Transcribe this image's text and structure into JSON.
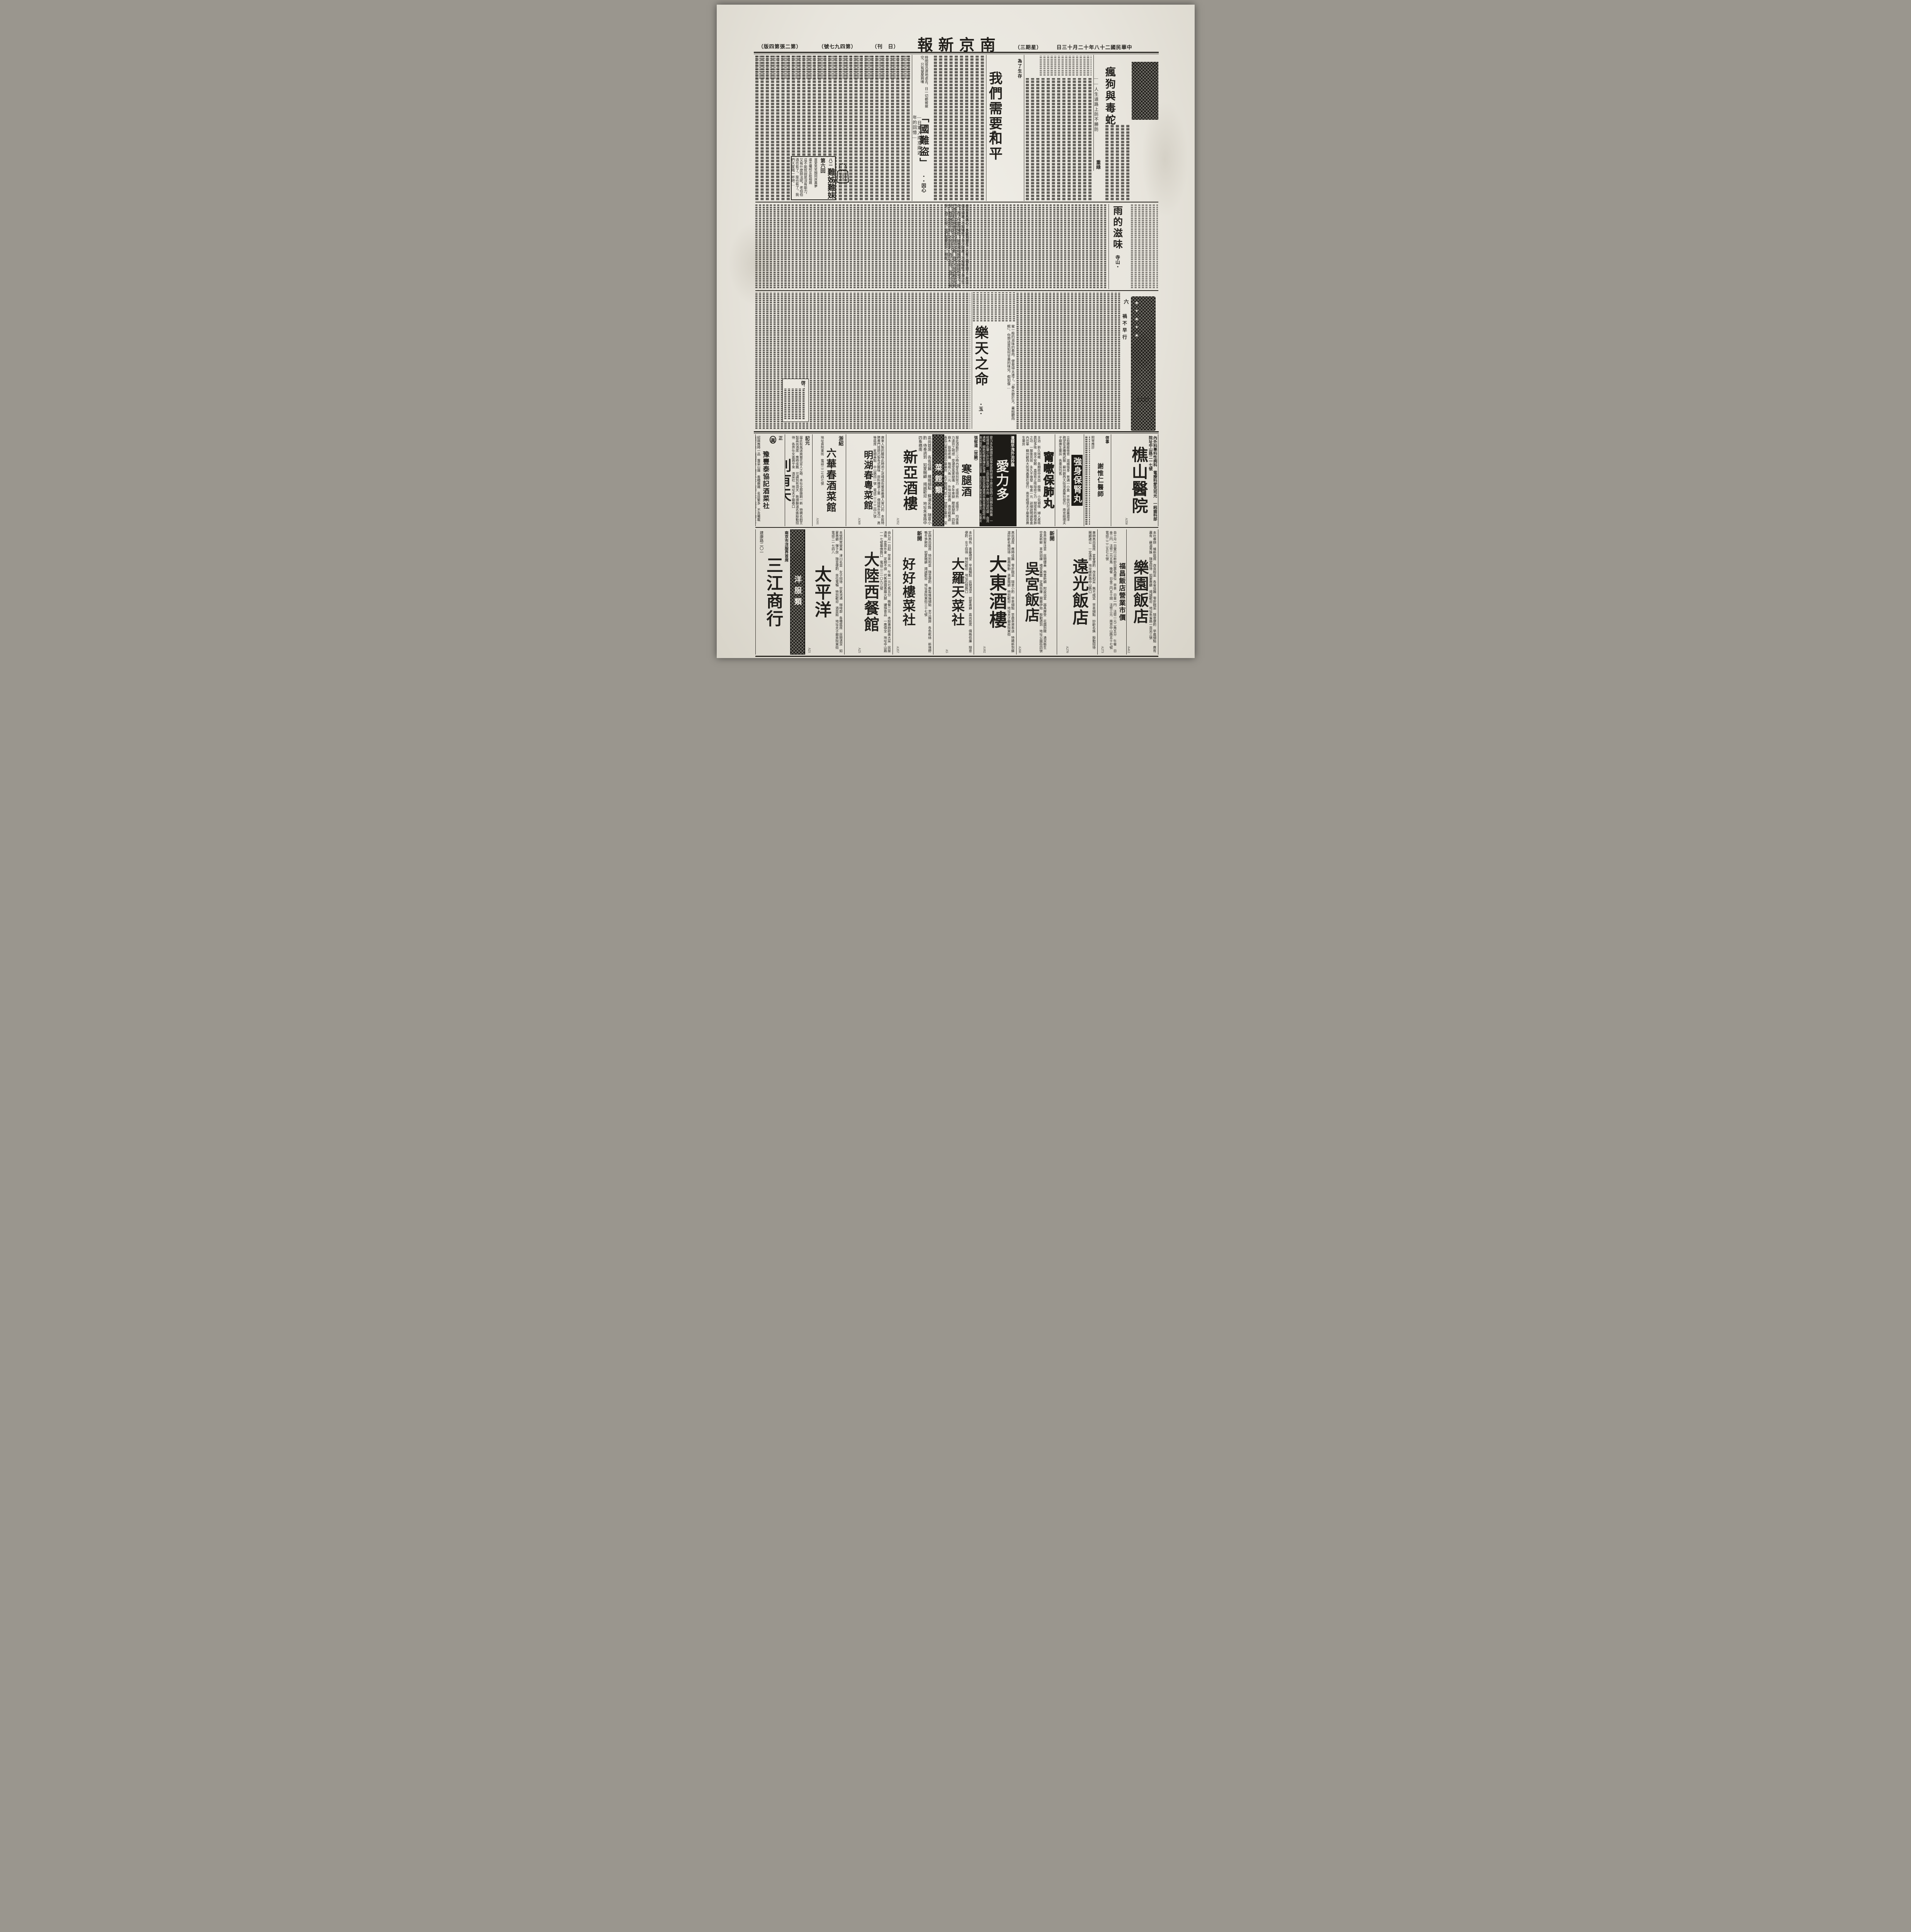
{
  "header": {
    "publication": "南京新報",
    "masthead_display": "報新京南",
    "edition_display": "（版四第張二第）",
    "issue_display": "（號七九四第）",
    "daily_display": "（刊　日）",
    "weekday_display": "（三期星）",
    "date": "中華民國二十八年十二月十三日",
    "date_display": "日三十月二十年八十二國民華中"
  },
  "articles": {
    "maddog": {
      "title": "瘋狗與毒蛇",
      "subtitle": "——人生道路上防不勝防",
      "author": "重綠"
    },
    "peace": {
      "kicker": "為了生存",
      "title": "我們需要和平",
      "author": "倩・",
      "excerpt": "說出來真痛心，事變到現在，已有二個年頭了，在這二個年頭裏，不知犧牲了多少財產！不知犧牲了多少生命！為了什麼而犧牲？誠意來和我們中國談和平了，我們應當趁這機會趕快的握手言歡，我們不是為戰爭而戰爭，戰爭僅是手段，不是目的，為了生存，我們可以戰爭，為了生存，我們需要和平，現在。"
    },
    "thief": {
      "title": "「國難盜」",
      "subtitle": "—日軍入南京兩週年的回憶—",
      "author": "・・因心",
      "excerpt": "時間很迅速地逝去，日一切都被搶空，只有望屋興嘆"
    },
    "rain": {
      "title": "雨的滋味",
      "author": "寺山・",
      "excerpt": "蜜一般的滋味的春雨，便覺得太遠了。「春水碧於天，畫船聽雨眠」，你想這是如何甘美的味兒，假如像…"
    },
    "fate": {
      "title": "樂天之命",
      "author": "・玉・"
    },
    "column6_num": "六",
    "column6_title": "禍不早行",
    "page_marker": "（二三）",
    "notice_label": "啓："
  },
  "serial": {
    "book_title": "難姊難妹",
    "installment_no": "八二",
    "chapter": "第六回",
    "couplet_right": "買愛笑笑顏同床異夢",
    "couplet_left": "遺言囑咐互助相親",
    "excerpt": "這不能就說是沒有能力，又有什麼辦法呢，老伯伯酒也有了，菜也有了，我們大家喝一杯吧…"
  },
  "ads_row1": [
    {
      "kicker": "正",
      "logo": "眞",
      "title": "豫豐泰協記酒菜社",
      "text": "紹興應時一品　蓴菜山雞　香糟嫩雞　名目繁多　不及備載　嫩肥羊糕　西湖醋魚　隨意小吃　歡迎一試　電話二一四三一九號",
      "code": ""
    },
    {
      "kicker": "記元",
      "title": "別有天",
      "text": "届此秋風送爽菊花宜人之時　本社全部振刷一新　特聘名廚烹製高尚酒席　應時佳餚　可謂別有洞天　敦請蘇滬名姝殷勤招待　各界仕女盍興乎來　酒菜社　地址夫子廟巷口",
      "code": "A25"
    },
    {
      "kicker": "浙紹",
      "title": "六華春酒菜館",
      "text": "地址貢院東街　電話二二七四七號",
      "code": "A161"
    },
    {
      "kicker": "",
      "title": "明湖春粵菜館",
      "text": "廣東人製的臘味此時用之送禮或佐餐是最適人胃口的　本館特聘專門技師巧製各式臘味　原料揀選上乘　價錢格外克己　高等筵席　星期美點　中山路四一號　電話二二二二四六號",
      "code": "A369"
    },
    {
      "kicker": "",
      "title": "新亞酒樓",
      "text": "高尚筵席　各省佳餚　維揚細點　蘇滬名姝　隨意小酌　侍奉週到　如蒙賜顧　竭誠歡迎　地址朱雀路中四象橋南",
      "code": "A352"
    },
    {
      "title": "菜館類"
    },
    {
      "kicker": "張郁道（效驗）",
      "title": "寒腿酒",
      "text": "服此酒能於二小時內發生特別效力　或微熱　或微汗　均係藥力達到之明證　受潮受風寒腿痛　多年寒腿　腰痠腿麻　四肢麻木　筋骨疼痛　每瓶八角一元　外埠加寄費　南京經售處　青島山東路南首中華藥房　夫子廟龍門街十一號廣生藥房　至誠藥社總經理",
      "code": "A388"
    },
    {
      "kicker": "遺精早洩外治妙藥",
      "title": "愛力多",
      "text": "愛力多為德國性病專家愛特那博士原方發明之固精外用新藥　一經擦搽此藥少許於當部　立即發揮化學作用　使分泌旺盛　血流通暢　細胞組織易臻於發達　堅固長期連用亦無習慣性副作用　蘇州觀西大街灣鑫藥社經理　南京夫子廟東首廣生藥房　各藥房均代售",
      "code": ""
    },
    {
      "kicker": "",
      "title": "甯嗽保肺丸",
      "text": "主治　新久咳嗽　各期痰中夾血　癆傷　小兒頓咳　婦人產咳　晨起多咳　夜不安眠　直接有止咳除痰之力　間接有防癆保肺之功　一服後見效　永久不復發　每盒一元　詳細說明請看盒內仿單　蘇州觀西大街灣鑫藥社發行　南京經理夫子廟東首廣生藥房",
      "code": ""
    },
    {
      "kicker": "",
      "title": "強身保腎丸",
      "text": "立愈腰痠倦背　滋補強身　普通一小盒　不效仍可退藥還洋　務望從速購備試服　蘇州觀西大街灣鑫藥社發行　南京經理夫子廟廣生藥房　各藥房均售",
      "code": ""
    },
    {
      "kicker": "啓事",
      "title": "謝惟仁醫師",
      "text": "照常應診",
      "code": ""
    },
    {
      "kicker": "",
      "title": "樵山醫院",
      "text": "內外科專科性病科　電療科愛克司光　一純齒科部　院址中山路二一七號",
      "code": "A350"
    }
  ],
  "ads_row2": [
    {
      "kicker": "南京市洋服界首席",
      "title": "三江商行",
      "text": "建康路二〇一",
      "code": ""
    },
    {
      "title": "洋服類"
    },
    {
      "kicker": "",
      "title": "太平洋",
      "text": "本號照常營業　津川名菜　女子招待　空氣流通　咖啡部　各種筵席　房間清潔　如蒙惠顧　彈子房　隨意便酌　坐位寬暢　特別歡迎　酒菜館　地址夫子廟貢院東街　電話二一七四八",
      "code": "A21"
    },
    {
      "kicker": "",
      "title": "大陸西餐館",
      "text": "由九月一日起　早茶一元　午餐一元七角五分　晚餐二元　本館專辦歐美大菜　房屋清雅　宴席外會　定期不誤　代售德國香腸火腿　罐頭食品　一應俱全　地址中山路一一七號華僑路口　電話二二一〇九三號",
      "code": "A25"
    },
    {
      "kicker": "新開",
      "title": "好好樓菜社",
      "text": "定辦高尚筵席　特別和菜　隨意便酌　專製維揚細點　京江餚蹄　各色乾絲　新增野鴨冬笋飽餃　如蒙賜顧　竭誠歡迎　地址貢院東街三十七號",
      "code": "A357"
    },
    {
      "kicker": "",
      "title": "大羅天菜社",
      "text": "本社特色　喜慶禮堂　早晨麵點　房間清潔　如蒙惠顧　高尚筵席　價格低廉　隨意便酌　女子招待　特別歡迎　地址石鼓路口",
      "code": "A5"
    },
    {
      "kicker": "",
      "title": "大東酒樓",
      "text": "高尚酒席　應時佳餚　零折碗菜　隨意小酌　早茶細點　早晨茶資奉送　特聘新到蘇滬妙齡名姝招待　服務慇勤　承蒙賜顧　特別歡迎　地址夫子廟貢院東街",
      "code": "A102"
    },
    {
      "kicker": "新開",
      "title": "吳宮飯店",
      "text": "各界旅客注意　房間優美　佈置新穎　附設浴室　器具摩登　花園別緻　清潔衛生　空氣新鮮　茶房訓練　禮堂富麗　定價低廉　開幕伊始　殷勤週到　地址公園街四號",
      "code": "A260"
    },
    {
      "kicker": "",
      "title": "遠光飯店",
      "text": "專辦高尚筵席　宴會便酌　改良和菜　無不咸宜　早茶細點　妙齡名姝　殷勤招待　賜顧諸公　一定滿意　地址維新路中山路口",
      "code": "A270"
    },
    {
      "kicker": "",
      "title": "福昌飯店營業市價",
      "text": "自十月一日實行以新鈔日票為單位　早茶　日金一円　法幣一元二角五分　午餐　日金二円　法幣二元五角　晚餐　日金二円五十錢　法幣三元　南京中山路五十七號　電話二二二五七七號",
      "code": "A273"
    },
    {
      "kicker": "",
      "title": "樂園飯店",
      "text": "本社專辦　維新筵席　改良和菜　各省佳餚　零折碗菜　隨意便酌　早晨細點　應有盡有　蘇滬秀姝　隨堂招待　如蒙惠顧　竭誠歡迎　地址朱雀路一百另三號",
      "code": "A412"
    }
  ]
}
